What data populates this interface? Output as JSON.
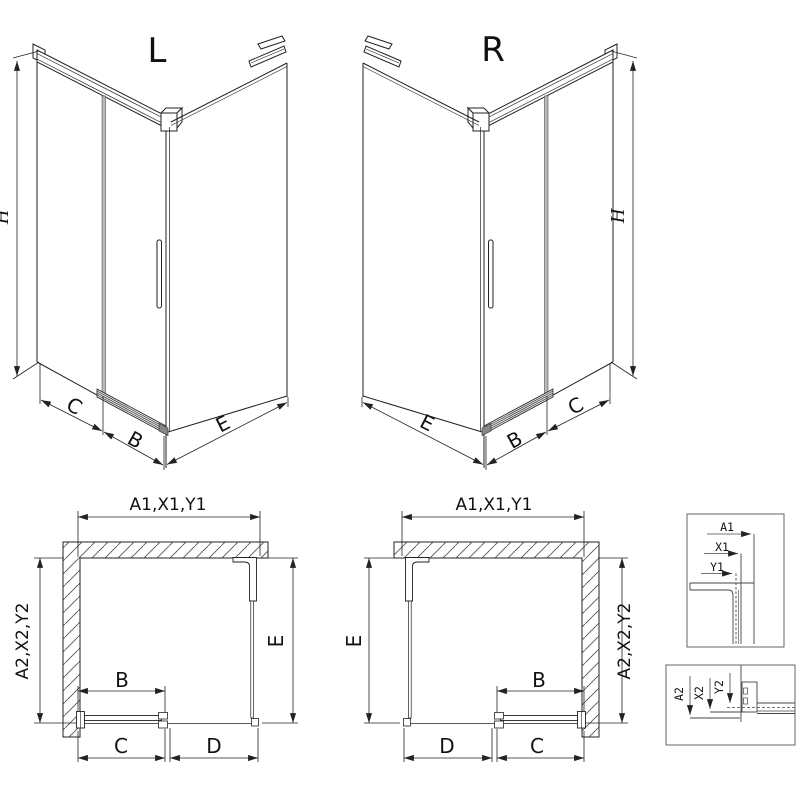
{
  "page": {
    "background": "#ffffff",
    "line_color": "#222222",
    "glass_seam_color": "#b8b8b8"
  },
  "views": {
    "iso_left": {
      "title": "L",
      "dim_height": "H",
      "dim_fixed_segment": "C",
      "dim_door_width": "B",
      "dim_side_panel": "E"
    },
    "iso_right": {
      "title": "R",
      "dim_height": "H",
      "dim_side_panel": "E",
      "dim_door_width": "B",
      "dim_fixed_segment": "C"
    },
    "plan_left": {
      "dim_width_group": "A1,X1,Y1",
      "dim_depth_group": "A2,X2,Y2",
      "dim_side_panel": "E",
      "dim_door_width": "B",
      "dim_bottom_inner": "C",
      "dim_bottom_outer": "D"
    },
    "plan_right": {
      "dim_width_group": "A1,X1,Y1",
      "dim_depth_group": "A2,X2,Y2",
      "dim_side_panel": "E",
      "dim_door_width": "B",
      "dim_bottom_outer": "D",
      "dim_bottom_inner": "C"
    },
    "detail_width_profile": {
      "dim_a": "A1",
      "dim_x": "X1",
      "dim_y": "Y1"
    },
    "detail_depth_profile": {
      "dim_a": "A2",
      "dim_x": "X2",
      "dim_y": "Y2"
    }
  }
}
